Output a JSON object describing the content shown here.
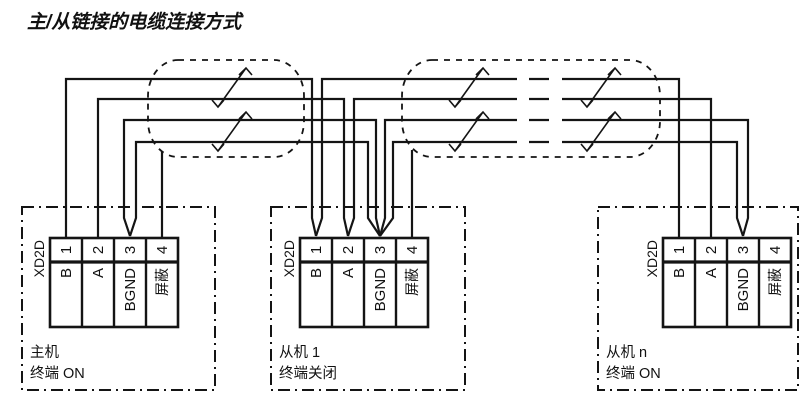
{
  "title": "主/从链接的电缆连接方式",
  "colors": {
    "ink": "#141414",
    "background": "#ffffff"
  },
  "connector": {
    "label": "XD2D",
    "pins": [
      {
        "number": "1",
        "name": "B"
      },
      {
        "number": "2",
        "name": "A"
      },
      {
        "number": "3",
        "name": "BGND"
      },
      {
        "number": "4",
        "name": "屏蔽"
      }
    ]
  },
  "devices": [
    {
      "name": "主机",
      "termination": "终端 ON"
    },
    {
      "name": "从机 1",
      "termination": "终端关闭"
    },
    {
      "name": "从机 n",
      "termination": "终端 ON"
    }
  ]
}
